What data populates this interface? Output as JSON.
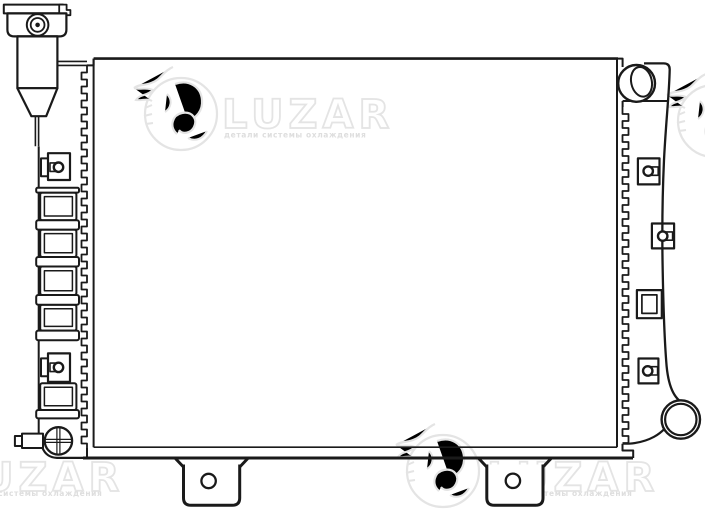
{
  "brand": {
    "name": "LUZAR",
    "tagline": "детали системы охлаждения"
  },
  "colors": {
    "line": "#1a1a1a",
    "background": "#ffffff",
    "watermark": "#e4e4e4",
    "watermark_fill": "#dedede"
  },
  "figure": {
    "kind": "technical line drawing",
    "subject": "radiator front view with filler neck, side tanks, inlet and outlet pipes, drain plug and mounting brackets"
  }
}
